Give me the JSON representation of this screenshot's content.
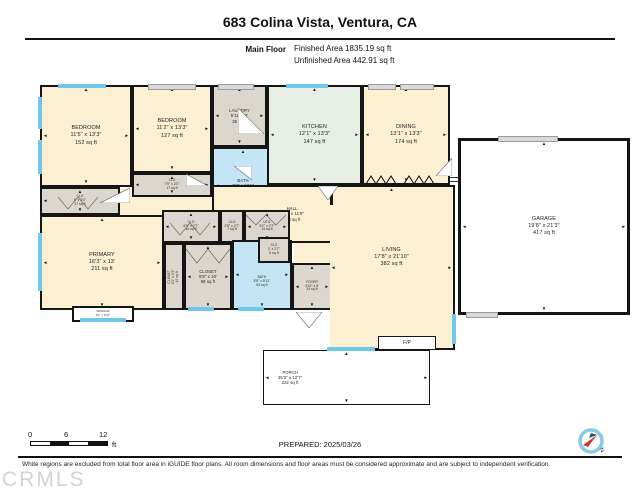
{
  "header": {
    "title": "683 Colina Vista, Ventura, CA",
    "floor_label": "Main Floor",
    "finished_area": "Finished Area 1835.19 sq ft",
    "unfinished_area": "Unfinished Area 442.91 sq ft"
  },
  "rooms": [
    {
      "name": "BEDROOM",
      "dims": "11'5\" x 13'3\"",
      "area": "152 sq ft"
    },
    {
      "name": "BEDROOM",
      "dims": "11'2\" x 13'3\"",
      "area": "127 sq ft"
    },
    {
      "name": "CLO",
      "dims": "7'9\" x 2'2\"",
      "area": "17 sq ft"
    },
    {
      "name": "LAUNDRY",
      "dims": "5'11\" x 6'",
      "area": "35 sq ft"
    },
    {
      "name": "BATH",
      "dims": "7'7\" x 6'11\"",
      "area": "48 sq ft"
    },
    {
      "name": "KITCHEN",
      "dims": "12'1\" x 13'3\"",
      "area": "147 sq ft"
    },
    {
      "name": "DINING",
      "dims": "13'1\" x 13'3\"",
      "area": "174 sq ft"
    },
    {
      "name": "GARAGE",
      "dims": "19'8\" x 21'3\"",
      "area": "417 sq ft"
    },
    {
      "name": "CLO",
      "dims": "8' x 3'4\"",
      "area": "27 sq ft"
    },
    {
      "name": "HALL",
      "dims": "26'9\" x 11'9\"",
      "area": "138 sq ft"
    },
    {
      "name": "CLO",
      "dims": "6'5\" x 2'7\"",
      "area": "16 sq ft"
    },
    {
      "name": "CLO",
      "dims": "2'9\" x 2'7\"",
      "area": "7 sq ft"
    },
    {
      "name": "UTIL",
      "dims": "5'2\" x 2'7\"",
      "area": "14 sq ft"
    },
    {
      "name": "CLO",
      "dims": "2' x 2'7\"",
      "area": "5 sq ft"
    },
    {
      "name": "PRIMARY",
      "dims": "16'3\" x 13'",
      "area": "211 sq ft"
    },
    {
      "name": "CLOSET",
      "dims": "2'2\" x 5'9\"",
      "area": "12 sq ft"
    },
    {
      "name": "CLOSET",
      "dims": "8'8\" x 10'",
      "area": "69 sq ft"
    },
    {
      "name": "BATH",
      "dims": "8'5\" x 8'11\"",
      "area": "53 sq ft"
    },
    {
      "name": "FOYER",
      "dims": "4'10\" x 5'",
      "area": "24 sq ft"
    },
    {
      "name": "LIVING",
      "dims": "17'8\" x 21'10\"",
      "area": "382 sq ft"
    },
    {
      "name": "PORCH",
      "dims": "25'3\" x 12'7\"",
      "area": "222 sq ft"
    }
  ],
  "extras": {
    "fireplace": "F/P",
    "bay_window_name": "WINDOW",
    "bay_window_dims": "9'1\" x 0'11\""
  },
  "footer": {
    "scale": {
      "zero": "0",
      "six": "6",
      "twelve": "12",
      "unit": "ft"
    },
    "prepared": "PREPARED: 2025/03/26",
    "compass_n": "N",
    "disclaimer": "White regions are excluded from total floor area in iGUIDE floor plans. All room dimensions and floor areas must be considered approximate and are subject to independent verification.",
    "watermark": "CRMLS"
  },
  "colors": {
    "wall": "#151515",
    "room_beige": "#FBF0D2",
    "room_gray": "#DCD7CE",
    "room_blue": "#C3E5F6",
    "room_green": "#E7EEE3",
    "window_blue": "#6FC7EC",
    "compass_ring": "#85CBE9",
    "compass_needle": "#D03A2B"
  }
}
